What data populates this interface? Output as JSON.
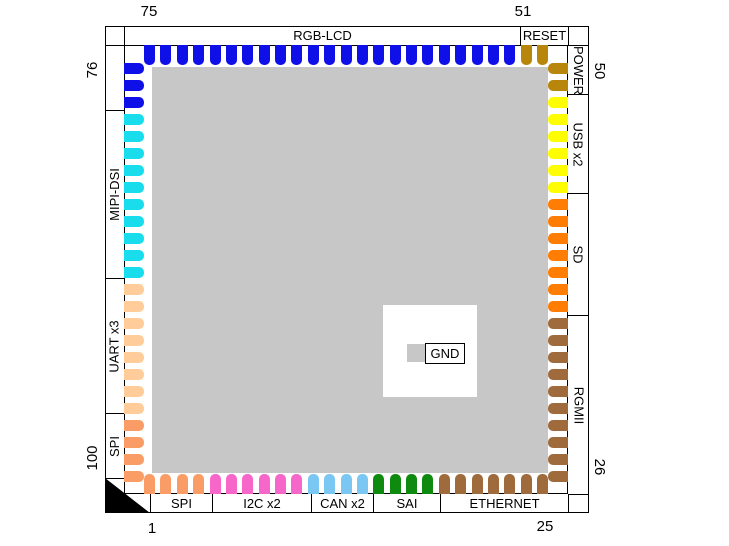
{
  "diagram_type": "100-pin chip package pinout",
  "corner_numbers": {
    "top_left": "75",
    "top_right": "51",
    "bottom_left": "1",
    "bottom_right": "25",
    "left_top": "76",
    "left_bottom": "100",
    "right_top": "50",
    "right_bottom": "26"
  },
  "edges": {
    "top": {
      "cells": [
        {
          "label": "RGB-LCD",
          "pins": 23,
          "color": "#0F0FE8"
        },
        {
          "label": "RESET",
          "pins": 2,
          "color": "#B8860B"
        }
      ]
    },
    "right": {
      "cells": [
        {
          "label": "POWER",
          "pins": 2,
          "color": "#B8860B"
        },
        {
          "label": "USB x2",
          "pins": 6,
          "color": "#FEFE00"
        },
        {
          "label": "SD",
          "pins": 7,
          "color": "#FF7D02"
        },
        {
          "label": "RGMII",
          "pins": 10,
          "color": "#A06B3C"
        }
      ]
    },
    "bottom": {
      "cells": [
        {
          "label": "SPI",
          "pins": 4,
          "color": "#FA9C66"
        },
        {
          "label": "I2C x2",
          "pins": 6,
          "color": "#F766C9"
        },
        {
          "label": "CAN x2",
          "pins": 4,
          "color": "#79C7F2"
        },
        {
          "label": "SAI",
          "pins": 4,
          "color": "#0E8B0E"
        },
        {
          "label": "ETHERNET",
          "pins": 7,
          "color": "#A06B3C"
        }
      ]
    },
    "left": {
      "cells": [
        {
          "label": "",
          "pins": 3,
          "color": "#0F0FE8"
        },
        {
          "label": "MIPI-DSI",
          "pins": 10,
          "color": "#19DCEC"
        },
        {
          "label": "UART x3",
          "pins": 8,
          "color": "#FFCC9A"
        },
        {
          "label": "SPI",
          "pins": 4,
          "color": "#FA9C66"
        }
      ]
    }
  },
  "legend": {
    "label": "GND",
    "swatch_color": "#C7C7C7"
  },
  "colors": {
    "center_pad": "#C7C7C7",
    "pin1_marker": "#000000",
    "outline": "#000000",
    "background": "#FFFFFF"
  }
}
